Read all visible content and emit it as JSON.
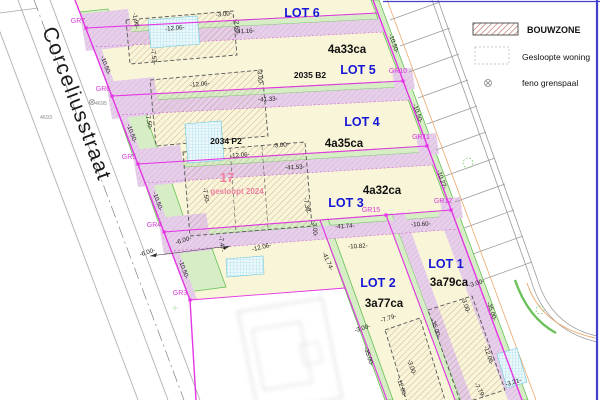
{
  "street": {
    "name": "Corceliusstraat",
    "labels": [
      {
        "t": "4695",
        "x": 101,
        "y": 105
      },
      {
        "t": "4693",
        "x": 46,
        "y": 119
      }
    ]
  },
  "legend": {
    "items": [
      {
        "symbol": "bouwzone-hatch-swatch",
        "label": "BOUWZONE"
      },
      {
        "symbol": "demolished-outline-swatch",
        "label": "Gesloopte woning"
      },
      {
        "symbol": "feno-marker-symbol",
        "label": "feno grenspaal"
      }
    ]
  },
  "lots": [
    {
      "name": "LOT 6",
      "area": null,
      "nx": 302,
      "ny": 17,
      "ax": 0,
      "ay": 0
    },
    {
      "name": "LOT 5",
      "area": "4a33ca",
      "nx": 358,
      "ny": 74,
      "ax": 347,
      "ay": 53
    },
    {
      "name": "LOT 4",
      "area": "4a35ca",
      "nx": 362,
      "ny": 126,
      "ax": 344,
      "ay": 147
    },
    {
      "name": "LOT 3",
      "area": "4a32ca",
      "nx": 346,
      "ny": 207,
      "ax": 382,
      "ay": 194
    },
    {
      "name": "LOT 2",
      "area": "3a77ca",
      "nx": 378,
      "ny": 287,
      "ax": 384,
      "ay": 307
    },
    {
      "name": "LOT 1",
      "area": "3a79ca",
      "nx": 446,
      "ny": 268,
      "ax": 449,
      "ay": 286
    }
  ],
  "parcels": {
    "p1": "2035 B2",
    "p2": "2034 P2",
    "demolished_number": "17",
    "demolished_note": "gesloopt 2024"
  },
  "gr_points": [
    {
      "label": "GR7",
      "x": 86,
      "y": 28,
      "lx": 78,
      "ly": 23
    },
    {
      "label": "GR6",
      "x": 112,
      "y": 96,
      "lx": 103,
      "ly": 91
    },
    {
      "label": "GR5",
      "x": 138,
      "y": 164,
      "lx": 129,
      "ly": 159
    },
    {
      "label": "GR4",
      "x": 164,
      "y": 232,
      "lx": 154,
      "ly": 227
    },
    {
      "label": "GR3",
      "x": 190,
      "y": 300,
      "lx": 180,
      "ly": 295
    },
    {
      "label": "GR10",
      "x": 403,
      "y": 81,
      "lx": 398,
      "ly": 73
    },
    {
      "label": "GR11",
      "x": 427,
      "y": 146,
      "lx": 421,
      "ly": 139
    },
    {
      "label": "GR12",
      "x": 451,
      "y": 210,
      "lx": 443,
      "ly": 203
    },
    {
      "label": "GR15",
      "x": 386,
      "y": 215,
      "lx": 371,
      "ly": 212
    }
  ],
  "dimensions": [
    {
      "t": "-10.50-",
      "x": 104,
      "y": 66,
      "r": 70
    },
    {
      "t": "-10.50-",
      "x": 130,
      "y": 134,
      "r": 70
    },
    {
      "t": "-10.50-",
      "x": 156,
      "y": 202,
      "r": 70
    },
    {
      "t": "-10.50-",
      "x": 182,
      "y": 270,
      "r": 70
    },
    {
      "t": "-10.50-",
      "x": 392,
      "y": 44,
      "r": 71
    },
    {
      "t": "-10.50-",
      "x": 416,
      "y": 114,
      "r": 71
    },
    {
      "t": "-10.27-",
      "x": 440,
      "y": 180,
      "r": 71
    },
    {
      "t": "-41.16-",
      "x": 245,
      "y": 33,
      "r": -3
    },
    {
      "t": "-41.33-",
      "x": 268,
      "y": 101,
      "r": -3
    },
    {
      "t": "-41.53-",
      "x": 295,
      "y": 169,
      "r": -3
    },
    {
      "t": "-41.74-",
      "x": 345,
      "y": 228,
      "r": -3
    },
    {
      "t": "-41.74-",
      "x": 326,
      "y": 262,
      "r": 66
    },
    {
      "t": "-10.82-",
      "x": 358,
      "y": 248,
      "r": -3
    },
    {
      "t": "-10.60-",
      "x": 421,
      "y": 226,
      "r": -3
    },
    {
      "t": "-35.00-",
      "x": 367,
      "y": 357,
      "r": 71
    },
    {
      "t": "-35.00-",
      "x": 434,
      "y": 329,
      "r": 71
    },
    {
      "t": "-35.00-",
      "x": 490,
      "y": 312,
      "r": 71
    },
    {
      "t": "-12.06-",
      "x": 175,
      "y": 30,
      "r": -5
    },
    {
      "t": "-3.00-",
      "x": 224,
      "y": 16,
      "r": -5
    },
    {
      "t": "-2.60-",
      "x": 235,
      "y": 27,
      "r": 86
    },
    {
      "t": "-1.96-",
      "x": 134,
      "y": 21,
      "r": 80
    },
    {
      "t": "-7.53-",
      "x": 152,
      "y": 57,
      "r": 82
    },
    {
      "t": "-12.06-",
      "x": 200,
      "y": 86,
      "r": -5
    },
    {
      "t": "-7.50-",
      "x": 147,
      "y": 122,
      "r": 80
    },
    {
      "t": "-3.00-",
      "x": 258,
      "y": 77,
      "r": 86
    },
    {
      "t": "-12.06-",
      "x": 240,
      "y": 157,
      "r": -5
    },
    {
      "t": "-3.00-",
      "x": 281,
      "y": 147,
      "r": -5
    },
    {
      "t": "-7.50-",
      "x": 204,
      "y": 196,
      "r": 80
    },
    {
      "t": "-7.38-",
      "x": 305,
      "y": 206,
      "r": 80
    },
    {
      "t": "-3.00-",
      "x": 313,
      "y": 229,
      "r": 86
    },
    {
      "t": "-6.00-",
      "x": 184,
      "y": 242,
      "r": -18
    },
    {
      "t": "-6.00-",
      "x": 148,
      "y": 254,
      "r": -18
    },
    {
      "t": "-7.47-",
      "x": 220,
      "y": 244,
      "r": 82
    },
    {
      "t": "-12.06-",
      "x": 262,
      "y": 249,
      "r": -14
    },
    {
      "t": "-3.00-",
      "x": 363,
      "y": 330,
      "r": -18
    },
    {
      "t": "-7.79-",
      "x": 389,
      "y": 320,
      "r": -18
    },
    {
      "t": "-3.00-",
      "x": 410,
      "y": 368,
      "r": 71
    },
    {
      "t": "-12.06-",
      "x": 400,
      "y": 388,
      "r": 71
    },
    {
      "t": "-3.00-",
      "x": 477,
      "y": 285,
      "r": -18
    },
    {
      "t": "-3.00-",
      "x": 464,
      "y": 306,
      "r": 71
    },
    {
      "t": "-12.06-",
      "x": 487,
      "y": 356,
      "r": 71
    },
    {
      "t": "-3.21-",
      "x": 514,
      "y": 384,
      "r": -18
    },
    {
      "t": "-7.79-",
      "x": 478,
      "y": 391,
      "r": 60
    }
  ],
  "colors": {
    "lot_fill": "#F9F5D8",
    "garden_green": "#D6EDC6",
    "green_line": "#66C054",
    "bouwzone_band": "#E6CFE9",
    "boundary_magenta": "#E535E5",
    "gr_label": "#D43CD4",
    "lot_text_blue": "#1616D6",
    "demolished_pink": "#EE7FA0",
    "hatch_brown": "#C09680",
    "legend_hatch_red": "#B05A48",
    "crosshatch_cyan": "#8AD4E6",
    "street_gray": "#A8A8A8",
    "orange_line": "#ECA96B",
    "frame_blue": "#4340CE"
  }
}
